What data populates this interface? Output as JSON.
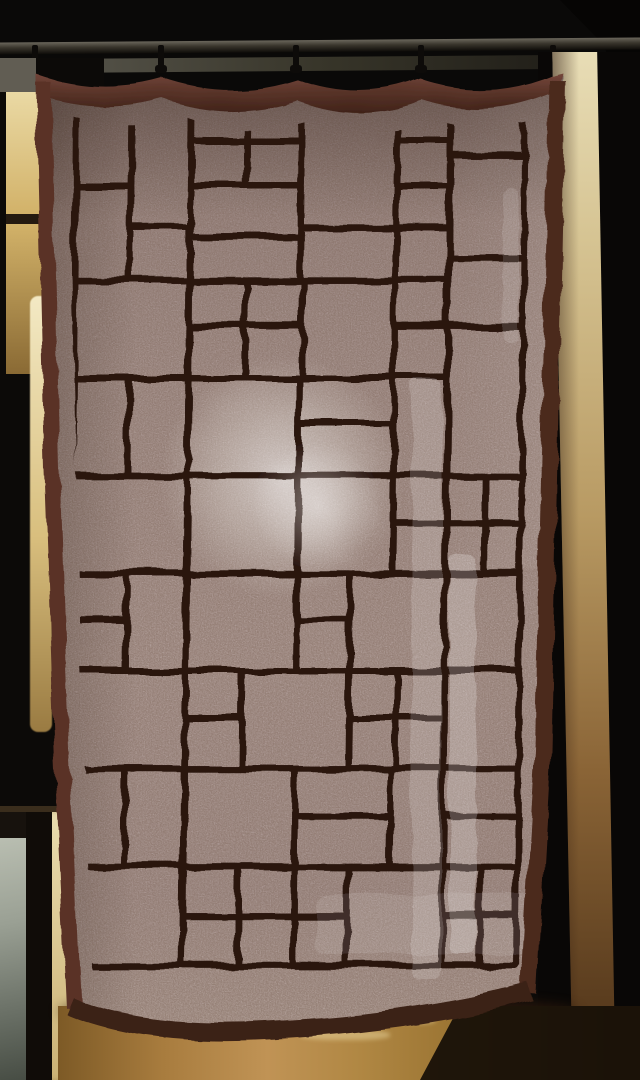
{
  "scene": {
    "type": "photograph",
    "subject": "Sheer beige linen curtain with hand-stitched dark brown patchwork grid pattern (stained-glass / Mondrian style), hanging from clip hooks on a dark rod inside a wooden doorway",
    "lighting": "Bright daylight behind fabric; round lamp-like glow in center; vertical window-light streaks; lit doorway gap at left; warm wood floor below",
    "visible_text": null
  },
  "colors": {
    "bg": "#0a0908",
    "rod_hi": "#6b675c",
    "rod_mid": "#39352c",
    "rod_dark": "#0e0c09",
    "wall_strip": "#8f8c7d",
    "grey_corner": "#7d7a6c",
    "gold_hi": "#ead9a4",
    "gold_mid": "#d2b269",
    "gold_dark": "#8a6a34",
    "sliver_hi": "#f3e9c4",
    "door_frame": "#17120d",
    "glass_hi": "#b9beb1",
    "glass_lo": "#474d44",
    "pale_hi": "#e9dcae",
    "pale_lo": "#cbb275",
    "wood_hi": "#e8ddb6",
    "wood_mid": "#b89a63",
    "wood_deep": "#4a2f16",
    "floor_hi": "#c09355",
    "floor_mid": "#a87c3e",
    "floor_dark": "#6f4e1f",
    "floor_shadow": "#301a0c",
    "fabric_top": "#a2908f",
    "fabric_mid": "#b7a6a4",
    "fabric_hi": "#beadaa",
    "fabric_low": "#c1b2ac",
    "line": "#2b1811",
    "hem": "#5a3127",
    "hem_dark": "#3a2015",
    "hem_right": "#4c2a1f",
    "swag_top": "#74463a",
    "swag_bot": "#3f2218",
    "glow": "#f4f2ee"
  },
  "rod": {
    "tilt_deg": -0.45,
    "hooks_x": [
      32,
      158,
      293,
      418,
      550
    ]
  },
  "curtain": {
    "line_width": 7,
    "pattern_cells": [
      [
        30,
        8,
        58,
        95
      ],
      [
        88,
        8,
        62,
        140
      ],
      [
        150,
        8,
        58,
        46
      ],
      [
        208,
        8,
        58,
        46
      ],
      [
        150,
        54,
        58,
        49
      ],
      [
        208,
        54,
        58,
        49
      ],
      [
        266,
        8,
        100,
        140
      ],
      [
        366,
        8,
        56,
        46
      ],
      [
        366,
        54,
        56,
        49
      ],
      [
        422,
        8,
        78,
        62
      ],
      [
        422,
        70,
        78,
        110
      ],
      [
        30,
        103,
        58,
        102
      ],
      [
        88,
        148,
        62,
        57
      ],
      [
        150,
        103,
        116,
        55
      ],
      [
        150,
        158,
        116,
        47
      ],
      [
        266,
        148,
        100,
        57
      ],
      [
        366,
        103,
        56,
        45
      ],
      [
        366,
        148,
        56,
        57
      ],
      [
        30,
        205,
        120,
        105
      ],
      [
        150,
        205,
        60,
        50
      ],
      [
        210,
        205,
        60,
        50
      ],
      [
        150,
        255,
        60,
        55
      ],
      [
        210,
        255,
        60,
        55
      ],
      [
        270,
        205,
        96,
        105
      ],
      [
        366,
        205,
        56,
        50
      ],
      [
        366,
        255,
        56,
        55
      ],
      [
        422,
        180,
        78,
        75
      ],
      [
        30,
        310,
        58,
        105
      ],
      [
        88,
        310,
        62,
        105
      ],
      [
        150,
        310,
        116,
        105
      ],
      [
        266,
        310,
        100,
        50
      ],
      [
        266,
        360,
        100,
        55
      ],
      [
        366,
        310,
        56,
        105
      ],
      [
        422,
        255,
        78,
        160
      ],
      [
        30,
        415,
        120,
        105
      ],
      [
        150,
        415,
        116,
        105
      ],
      [
        266,
        415,
        100,
        105
      ],
      [
        366,
        415,
        56,
        50
      ],
      [
        366,
        465,
        56,
        55
      ],
      [
        422,
        415,
        40,
        50
      ],
      [
        462,
        415,
        38,
        50
      ],
      [
        422,
        465,
        40,
        55
      ],
      [
        462,
        465,
        38,
        55
      ],
      [
        30,
        520,
        58,
        50
      ],
      [
        30,
        570,
        58,
        55
      ],
      [
        88,
        520,
        62,
        105
      ],
      [
        150,
        520,
        116,
        105
      ],
      [
        266,
        520,
        56,
        50
      ],
      [
        266,
        570,
        56,
        55
      ],
      [
        322,
        520,
        100,
        105
      ],
      [
        422,
        520,
        78,
        105
      ],
      [
        30,
        625,
        120,
        105
      ],
      [
        150,
        625,
        60,
        50
      ],
      [
        150,
        675,
        60,
        55
      ],
      [
        210,
        625,
        112,
        105
      ],
      [
        322,
        625,
        50,
        50
      ],
      [
        372,
        625,
        50,
        50
      ],
      [
        322,
        675,
        50,
        55
      ],
      [
        372,
        675,
        50,
        55
      ],
      [
        422,
        625,
        78,
        105
      ],
      [
        30,
        730,
        58,
        105
      ],
      [
        88,
        730,
        62,
        105
      ],
      [
        150,
        730,
        116,
        105
      ],
      [
        266,
        730,
        100,
        50
      ],
      [
        266,
        780,
        100,
        55
      ],
      [
        366,
        730,
        56,
        105
      ],
      [
        422,
        730,
        78,
        50
      ],
      [
        422,
        780,
        78,
        55
      ],
      [
        30,
        835,
        120,
        107
      ],
      [
        150,
        835,
        58,
        53
      ],
      [
        208,
        835,
        58,
        53
      ],
      [
        150,
        888,
        58,
        54
      ],
      [
        208,
        888,
        58,
        54
      ],
      [
        266,
        835,
        56,
        53
      ],
      [
        266,
        888,
        56,
        54
      ],
      [
        322,
        835,
        100,
        107
      ],
      [
        422,
        835,
        40,
        53
      ],
      [
        462,
        835,
        38,
        53
      ],
      [
        422,
        888,
        40,
        54
      ],
      [
        462,
        888,
        38,
        54
      ]
    ],
    "lighting": {
      "glow_center": [
        266,
        427
      ],
      "glow_radius": 122,
      "glow_core": [
        301,
        455
      ],
      "glow_core_radius": 64,
      "streaks": [
        [
          396,
          330,
          30,
          600,
          0.16
        ],
        [
          434,
          505,
          26,
          400,
          0.22
        ],
        [
          486,
          137,
          16,
          155,
          0.12
        ],
        [
          300,
          845,
          215,
          60,
          0.1
        ]
      ]
    }
  },
  "floor_glints": [
    [
      300,
      1030,
      90,
      10
    ],
    [
      396,
      1016,
      40,
      8
    ]
  ]
}
